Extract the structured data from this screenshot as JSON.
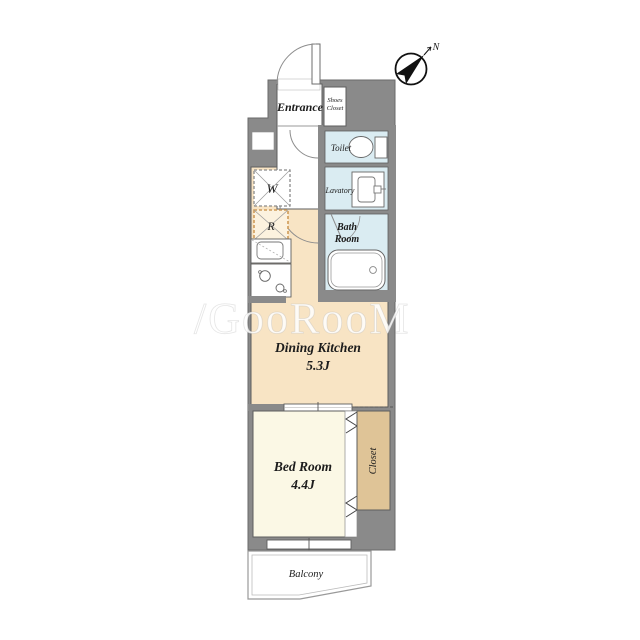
{
  "plan": {
    "compass": {
      "label": "N"
    },
    "watermark": "/GooRooM",
    "rooms": {
      "entrance": {
        "label": "Entrance"
      },
      "shoes_closet": {
        "line1": "Shoes",
        "line2": "Closet"
      },
      "toilet": {
        "label": "Toilet"
      },
      "lavatory": {
        "label": "Lavatory"
      },
      "bath_room": {
        "line1": "Bath",
        "line2": "Room"
      },
      "dining_kitchen": {
        "label": "Dining Kitchen",
        "size": "5.3J"
      },
      "bed_room": {
        "label": "Bed Room",
        "size": "4.4J"
      },
      "closet": {
        "label": "Closet"
      },
      "balcony": {
        "label": "Balcony"
      }
    },
    "symbols": {
      "washer": "W",
      "refrigerator": "R"
    },
    "colors": {
      "wall": "#8a8a8a",
      "dining_kitchen": "#f8e4c4",
      "bed_room": "#fbf8e5",
      "closet": "#dfc497",
      "wet_area": "#daecf2",
      "fridge_dash": "#cf9b59"
    }
  }
}
